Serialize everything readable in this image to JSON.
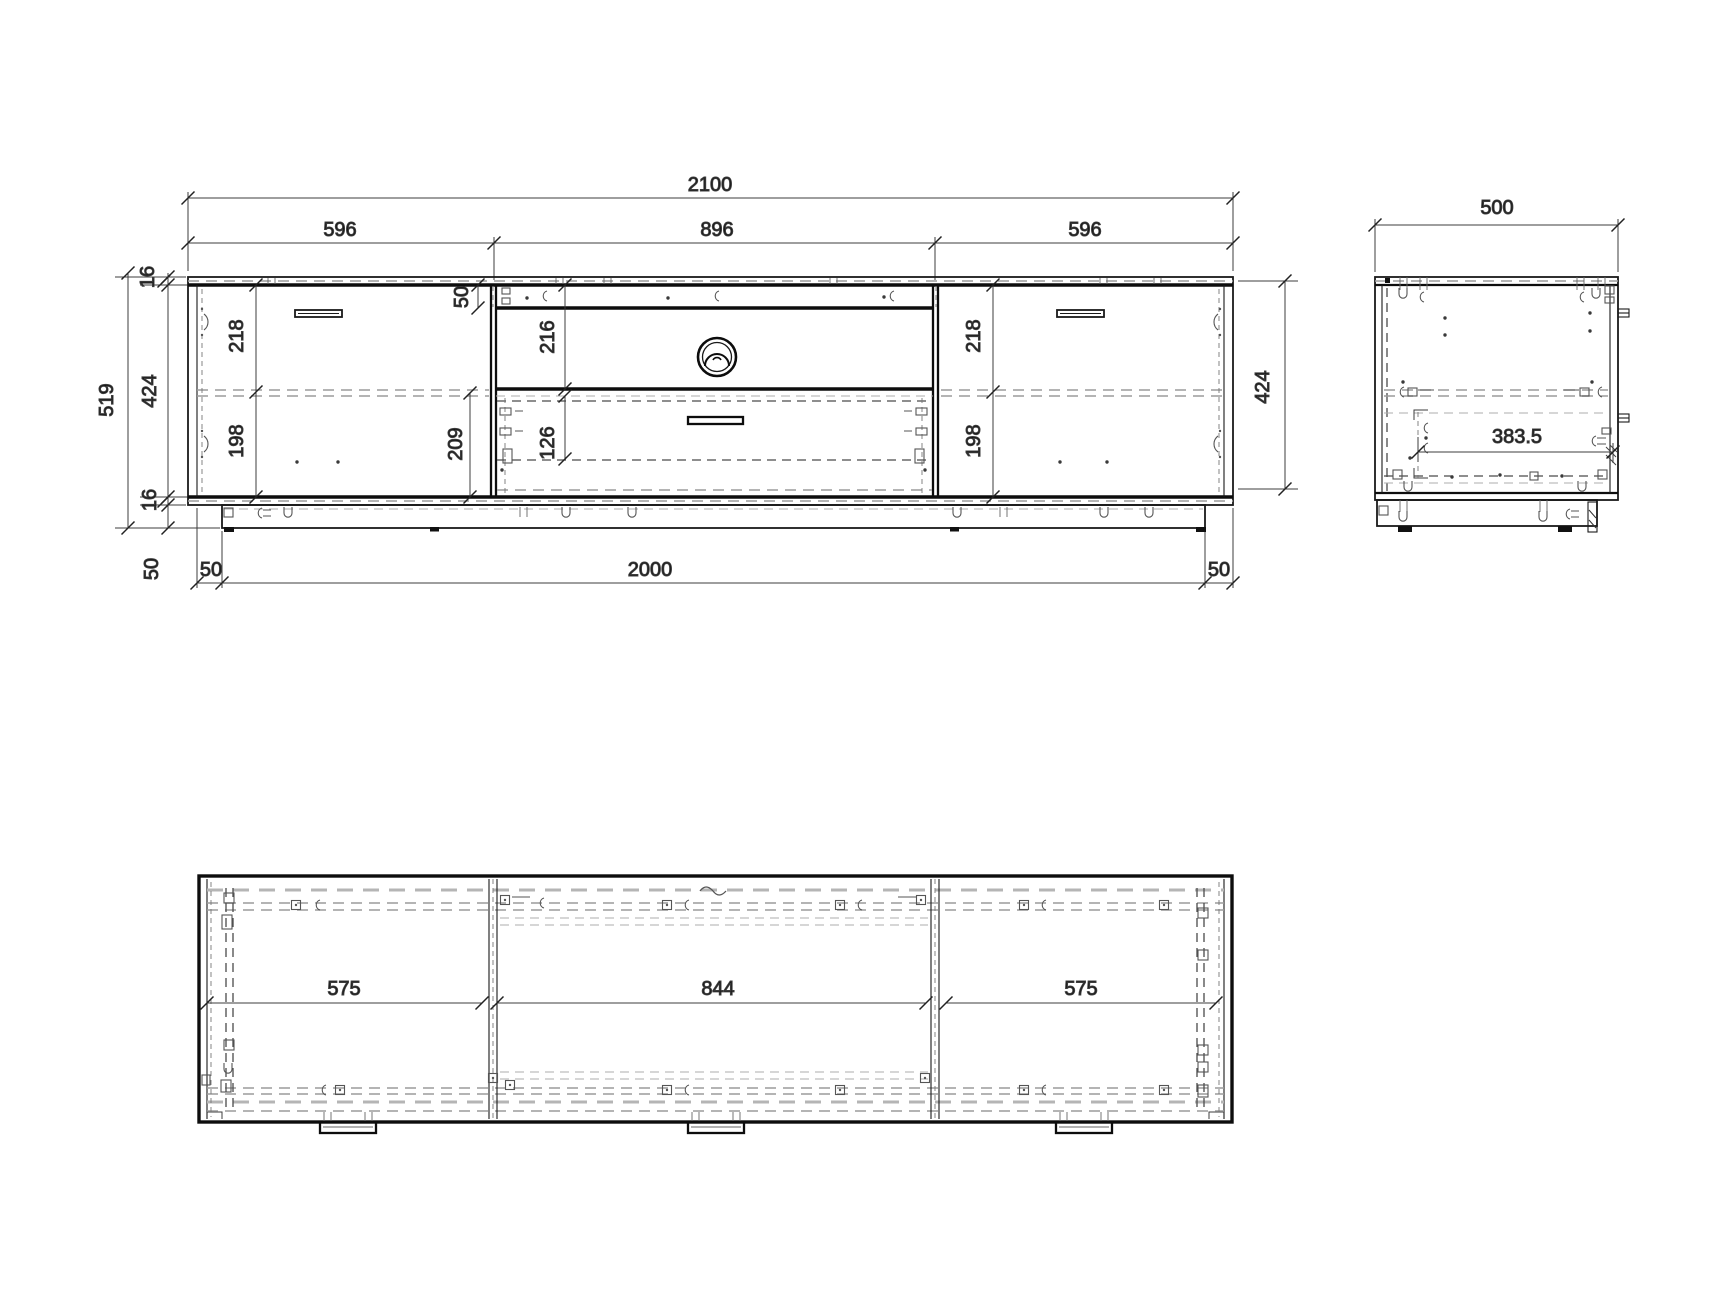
{
  "front_view": {
    "overall_width": "2100",
    "left_section_width": "596",
    "middle_section_width": "896",
    "right_section_width": "596",
    "overall_height": "519",
    "top_panel_thickness": "16",
    "interior_height": "424",
    "bottom_panel_thickness": "16",
    "plinth_height": "50",
    "plinth_left_inset": "50",
    "plinth_length": "2000",
    "plinth_right_inset": "50",
    "top_rail_height": "50",
    "tv_compartment_height": "216",
    "left_upper_compartment": "218",
    "left_lower_compartment": "198",
    "drawer_opening_height": "209",
    "drawer_front_height": "126",
    "right_upper_compartment": "218",
    "right_lower_compartment": "198"
  },
  "side_view": {
    "overall_depth": "500",
    "carcass_height": "424",
    "interior_depth": "383.5"
  },
  "plan_view": {
    "left_section_width": "575",
    "middle_section_width": "844",
    "right_section_width": "575"
  }
}
